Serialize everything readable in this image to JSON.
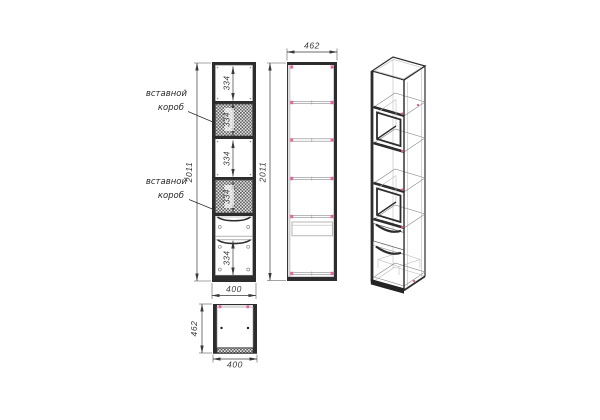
{
  "drawing": {
    "type": "cabinet-technical-drawing",
    "views": {
      "front": {
        "height_mm": "2011",
        "width_mm": "400",
        "sections": {
          "top": "334",
          "upper_box": "334",
          "middle": "334",
          "lower_box": "334",
          "bottom": "334"
        }
      },
      "side": {
        "depth_mm": "462",
        "height_mm": "2011"
      },
      "plan": {
        "width_mm": "400",
        "depth_mm": "462"
      }
    },
    "callouts": {
      "upper": {
        "line1": "вставной",
        "line2": "короб"
      },
      "lower": {
        "line1": "вставной",
        "line2": "короб"
      }
    },
    "colors": {
      "line": "#2d2d2d",
      "dim_line": "#3a3a3a",
      "thin_line": "#8a8a8a",
      "hidden_line": "#bdbdbd",
      "marker_pink": "#e8649e",
      "hatch": "#575757",
      "background": "#ffffff"
    }
  }
}
